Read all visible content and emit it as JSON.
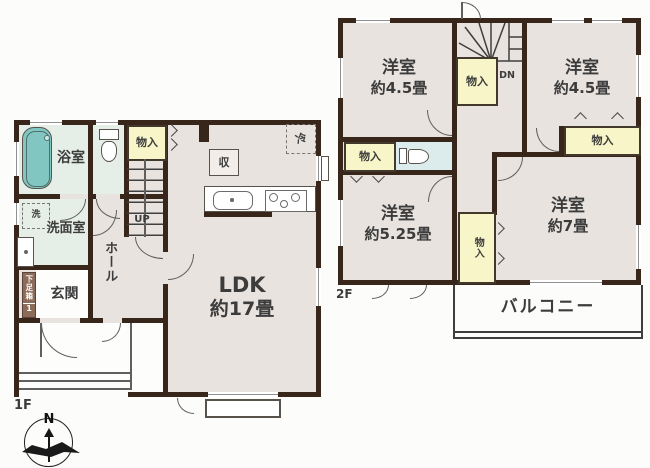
{
  "colors": {
    "wall": "#38261a",
    "floor": "#e9e3df",
    "wet_room": "#e6efe7",
    "toilet_room": "#dcecec",
    "closet": "#f8f5c8",
    "bathtub": "#82c6c2",
    "shoe_cabinet_brown": "#8c6b59"
  },
  "plan_1f": {
    "floor_label": "1F",
    "rooms": {
      "bathroom": {
        "name": "浴室"
      },
      "washroom": {
        "name": "洗面室"
      },
      "entrance": {
        "name": "玄関"
      },
      "hall": {
        "name": "ホール"
      },
      "ldk": {
        "name": "LDK",
        "size": "約17畳"
      }
    },
    "features": {
      "storage": "物入",
      "kitchen_storage": "収",
      "refrigerator": "冷",
      "washer": "洗",
      "shoe_cabinet": "下足箱",
      "shoe_cabinet_count": "1",
      "stairs": "UP"
    }
  },
  "plan_2f": {
    "floor_label": "2F",
    "rooms": {
      "bedroom_nw": {
        "name": "洋室",
        "size": "約4.5畳"
      },
      "bedroom_ne": {
        "name": "洋室",
        "size": "約4.5畳"
      },
      "bedroom_sw": {
        "name": "洋室",
        "size": "約5.25畳"
      },
      "bedroom_se": {
        "name": "洋室",
        "size": "約7畳"
      },
      "balcony": {
        "name": "バルコニー"
      }
    },
    "features": {
      "closet_by_stairs": "物入",
      "closet_west": "物入",
      "closet_east": "物入",
      "closet_center": "物入",
      "stairs": "DN"
    }
  },
  "compass": {
    "north": "N"
  }
}
